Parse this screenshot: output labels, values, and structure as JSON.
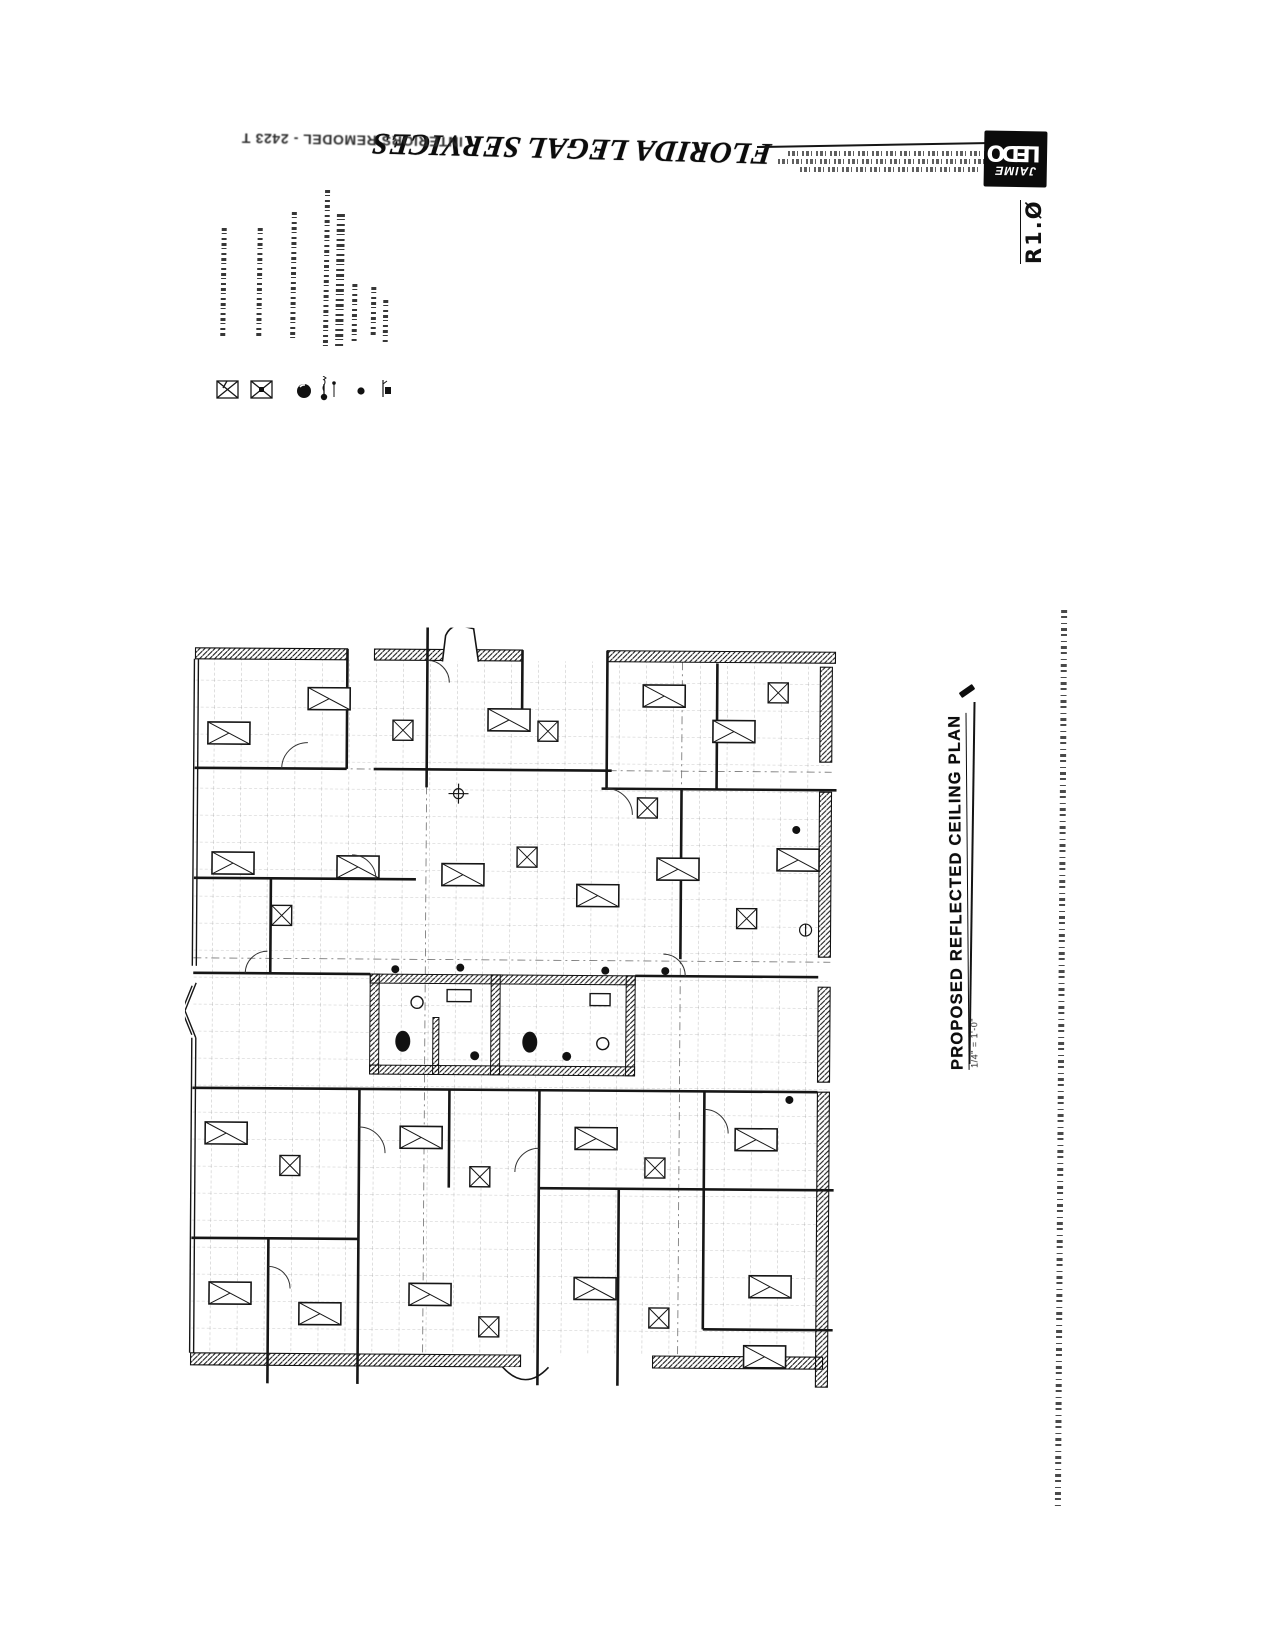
{
  "titleblock": {
    "project_title": "FLORIDA LEGAL SERVICES",
    "project_subtitle": "INTERIORS REMODEL - 2423 T",
    "logo_line1": "JAIME",
    "logo_line2": "LEDO",
    "sheet_number": "R1.Ø"
  },
  "plan": {
    "title": "PROPOSED REFLECTED CEILING PLAN",
    "scale": "1/4\" = 1'-0\""
  },
  "legend": {
    "symbols": [
      "fixture-2x2-troffer",
      "fixture-2x2-troffer-dot",
      "downlight",
      "exit-light",
      "ceiling-dot",
      "sprinkler-head"
    ]
  }
}
